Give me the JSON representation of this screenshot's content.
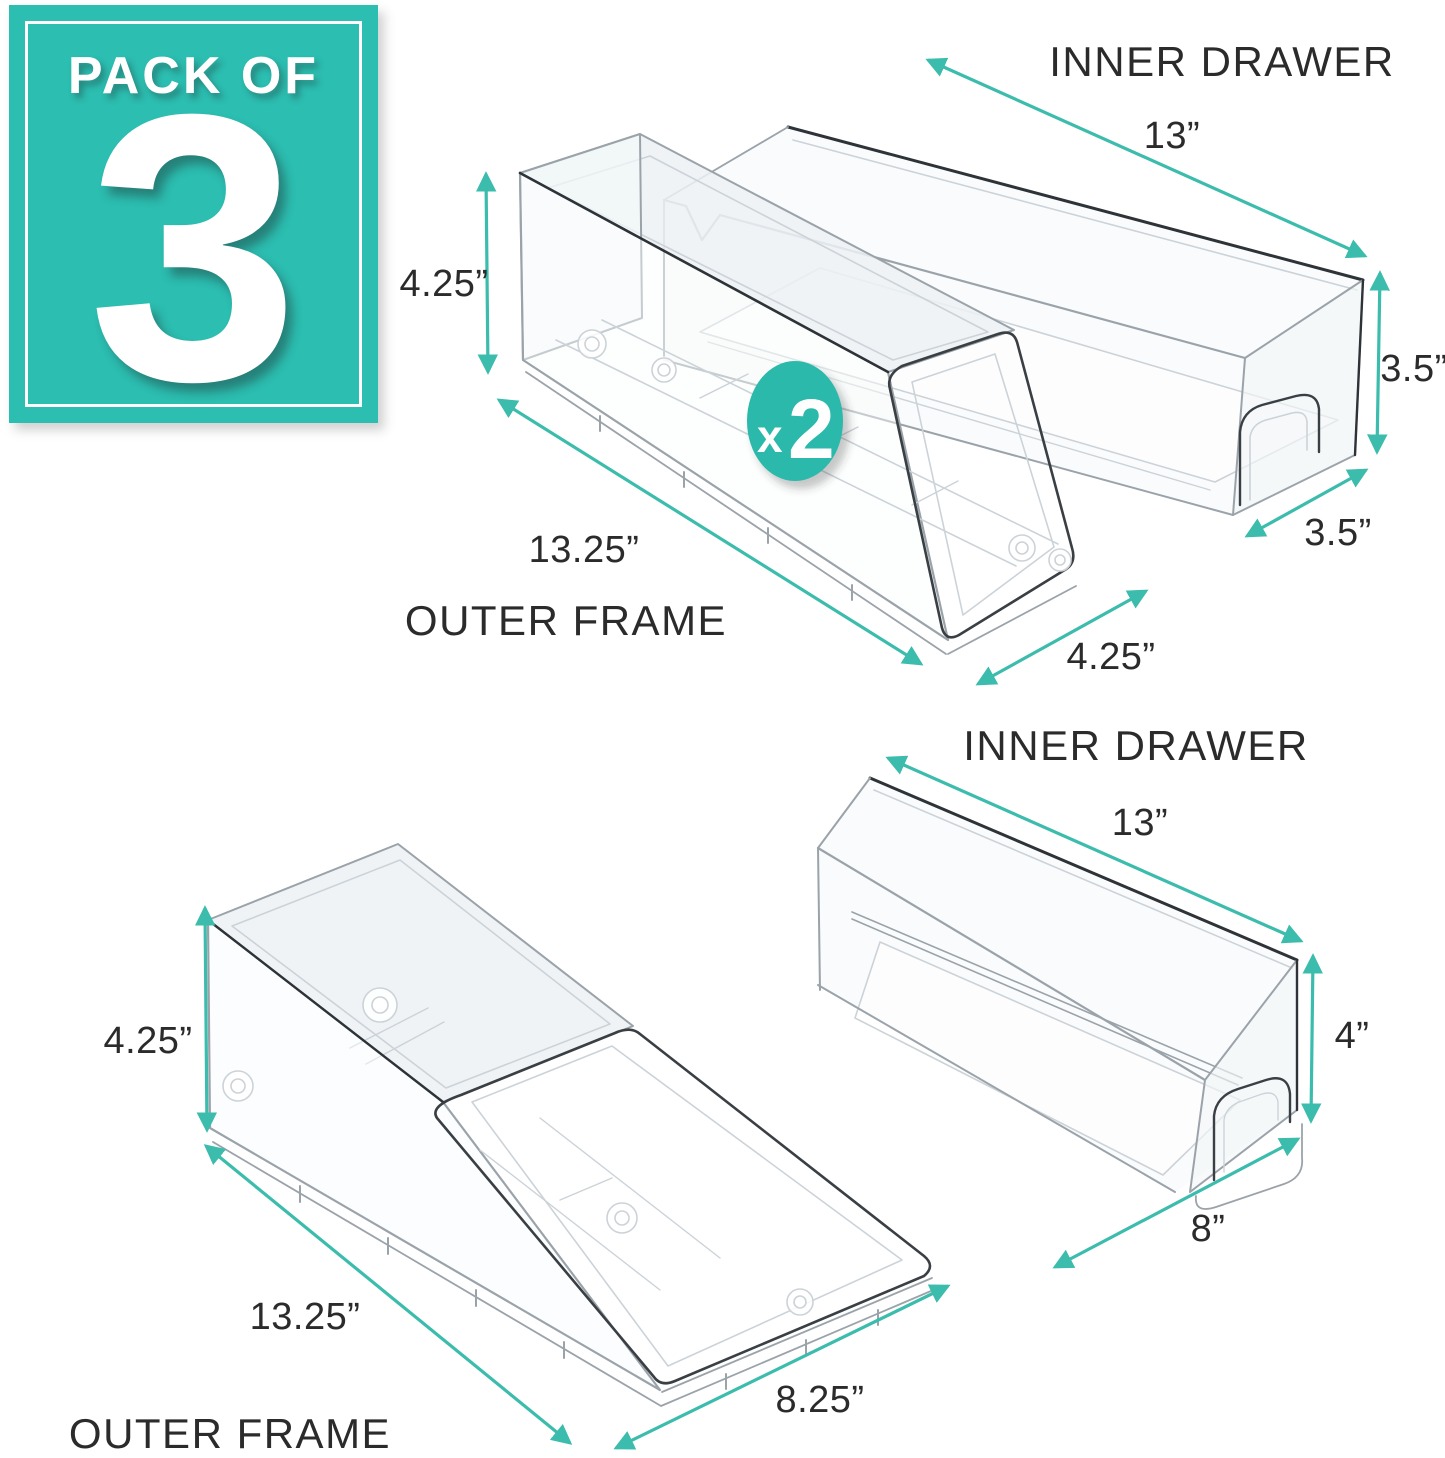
{
  "pack_badge": {
    "prefix": "PACK OF",
    "count": "3"
  },
  "multiplier_badge": {
    "x": "x",
    "count": "2"
  },
  "colors": {
    "badge_teal": "#2cbeb1",
    "multiplier_teal": "#2bb9ab",
    "arrow_teal": "#3bbcac",
    "line_dark": "#2e3338",
    "line_mid": "#9ba3aa",
    "line_light": "#ccd3d8",
    "label_text": "#2b2b2b"
  },
  "top_group": {
    "inner_drawer_label": "INNER DRAWER",
    "outer_frame_label": "OUTER FRAME",
    "inner_length": "13”",
    "inner_height": "3.5”",
    "inner_depth": "3.5”",
    "outer_height": "4.25”",
    "outer_length": "13.25”",
    "outer_depth": "4.25”"
  },
  "bottom_group": {
    "inner_drawer_label": "INNER DRAWER",
    "outer_frame_label": "OUTER FRAME",
    "inner_length": "13”",
    "inner_height": "4”",
    "inner_depth": "8”",
    "outer_height": "4.25”",
    "outer_length": "13.25”",
    "outer_depth": "8.25”"
  }
}
